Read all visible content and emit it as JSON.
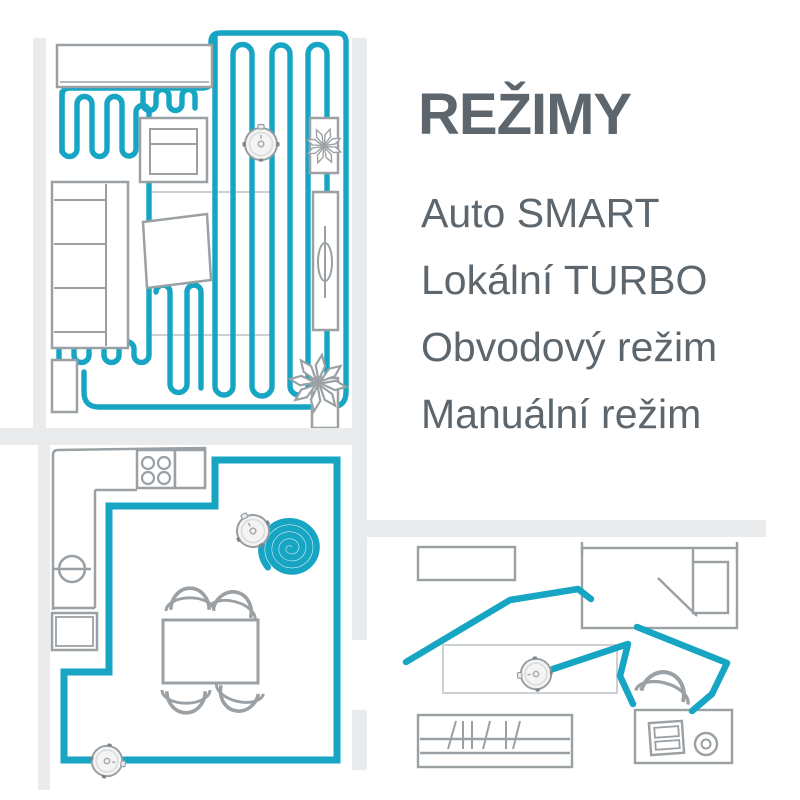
{
  "title": "REŽIMY",
  "modes": [
    "Auto SMART",
    "Lokální TURBO",
    "Obvodový režim",
    "Manuální režim"
  ],
  "colors": {
    "path_teal": "#16a5c3",
    "text_gray": "#5d666d",
    "furniture_sketch_gray": "#9aa0a4",
    "wall_light_gray": "#e9ebec",
    "rug_gray": "#cdd1d3"
  },
  "icons": {
    "robot": "robot-vacuum-icon",
    "plant": "plant-icon",
    "spiral": "turbo-spiral-path-icon",
    "serpentine": "auto-smart-path-icon",
    "perimeter": "perimeter-path-icon",
    "manual_path": "manual-drive-path-icon"
  },
  "floorplans": [
    {
      "name": "living-room-auto-smart"
    },
    {
      "name": "kitchen-turbo-and-perimeter"
    },
    {
      "name": "study-room-manual"
    }
  ]
}
